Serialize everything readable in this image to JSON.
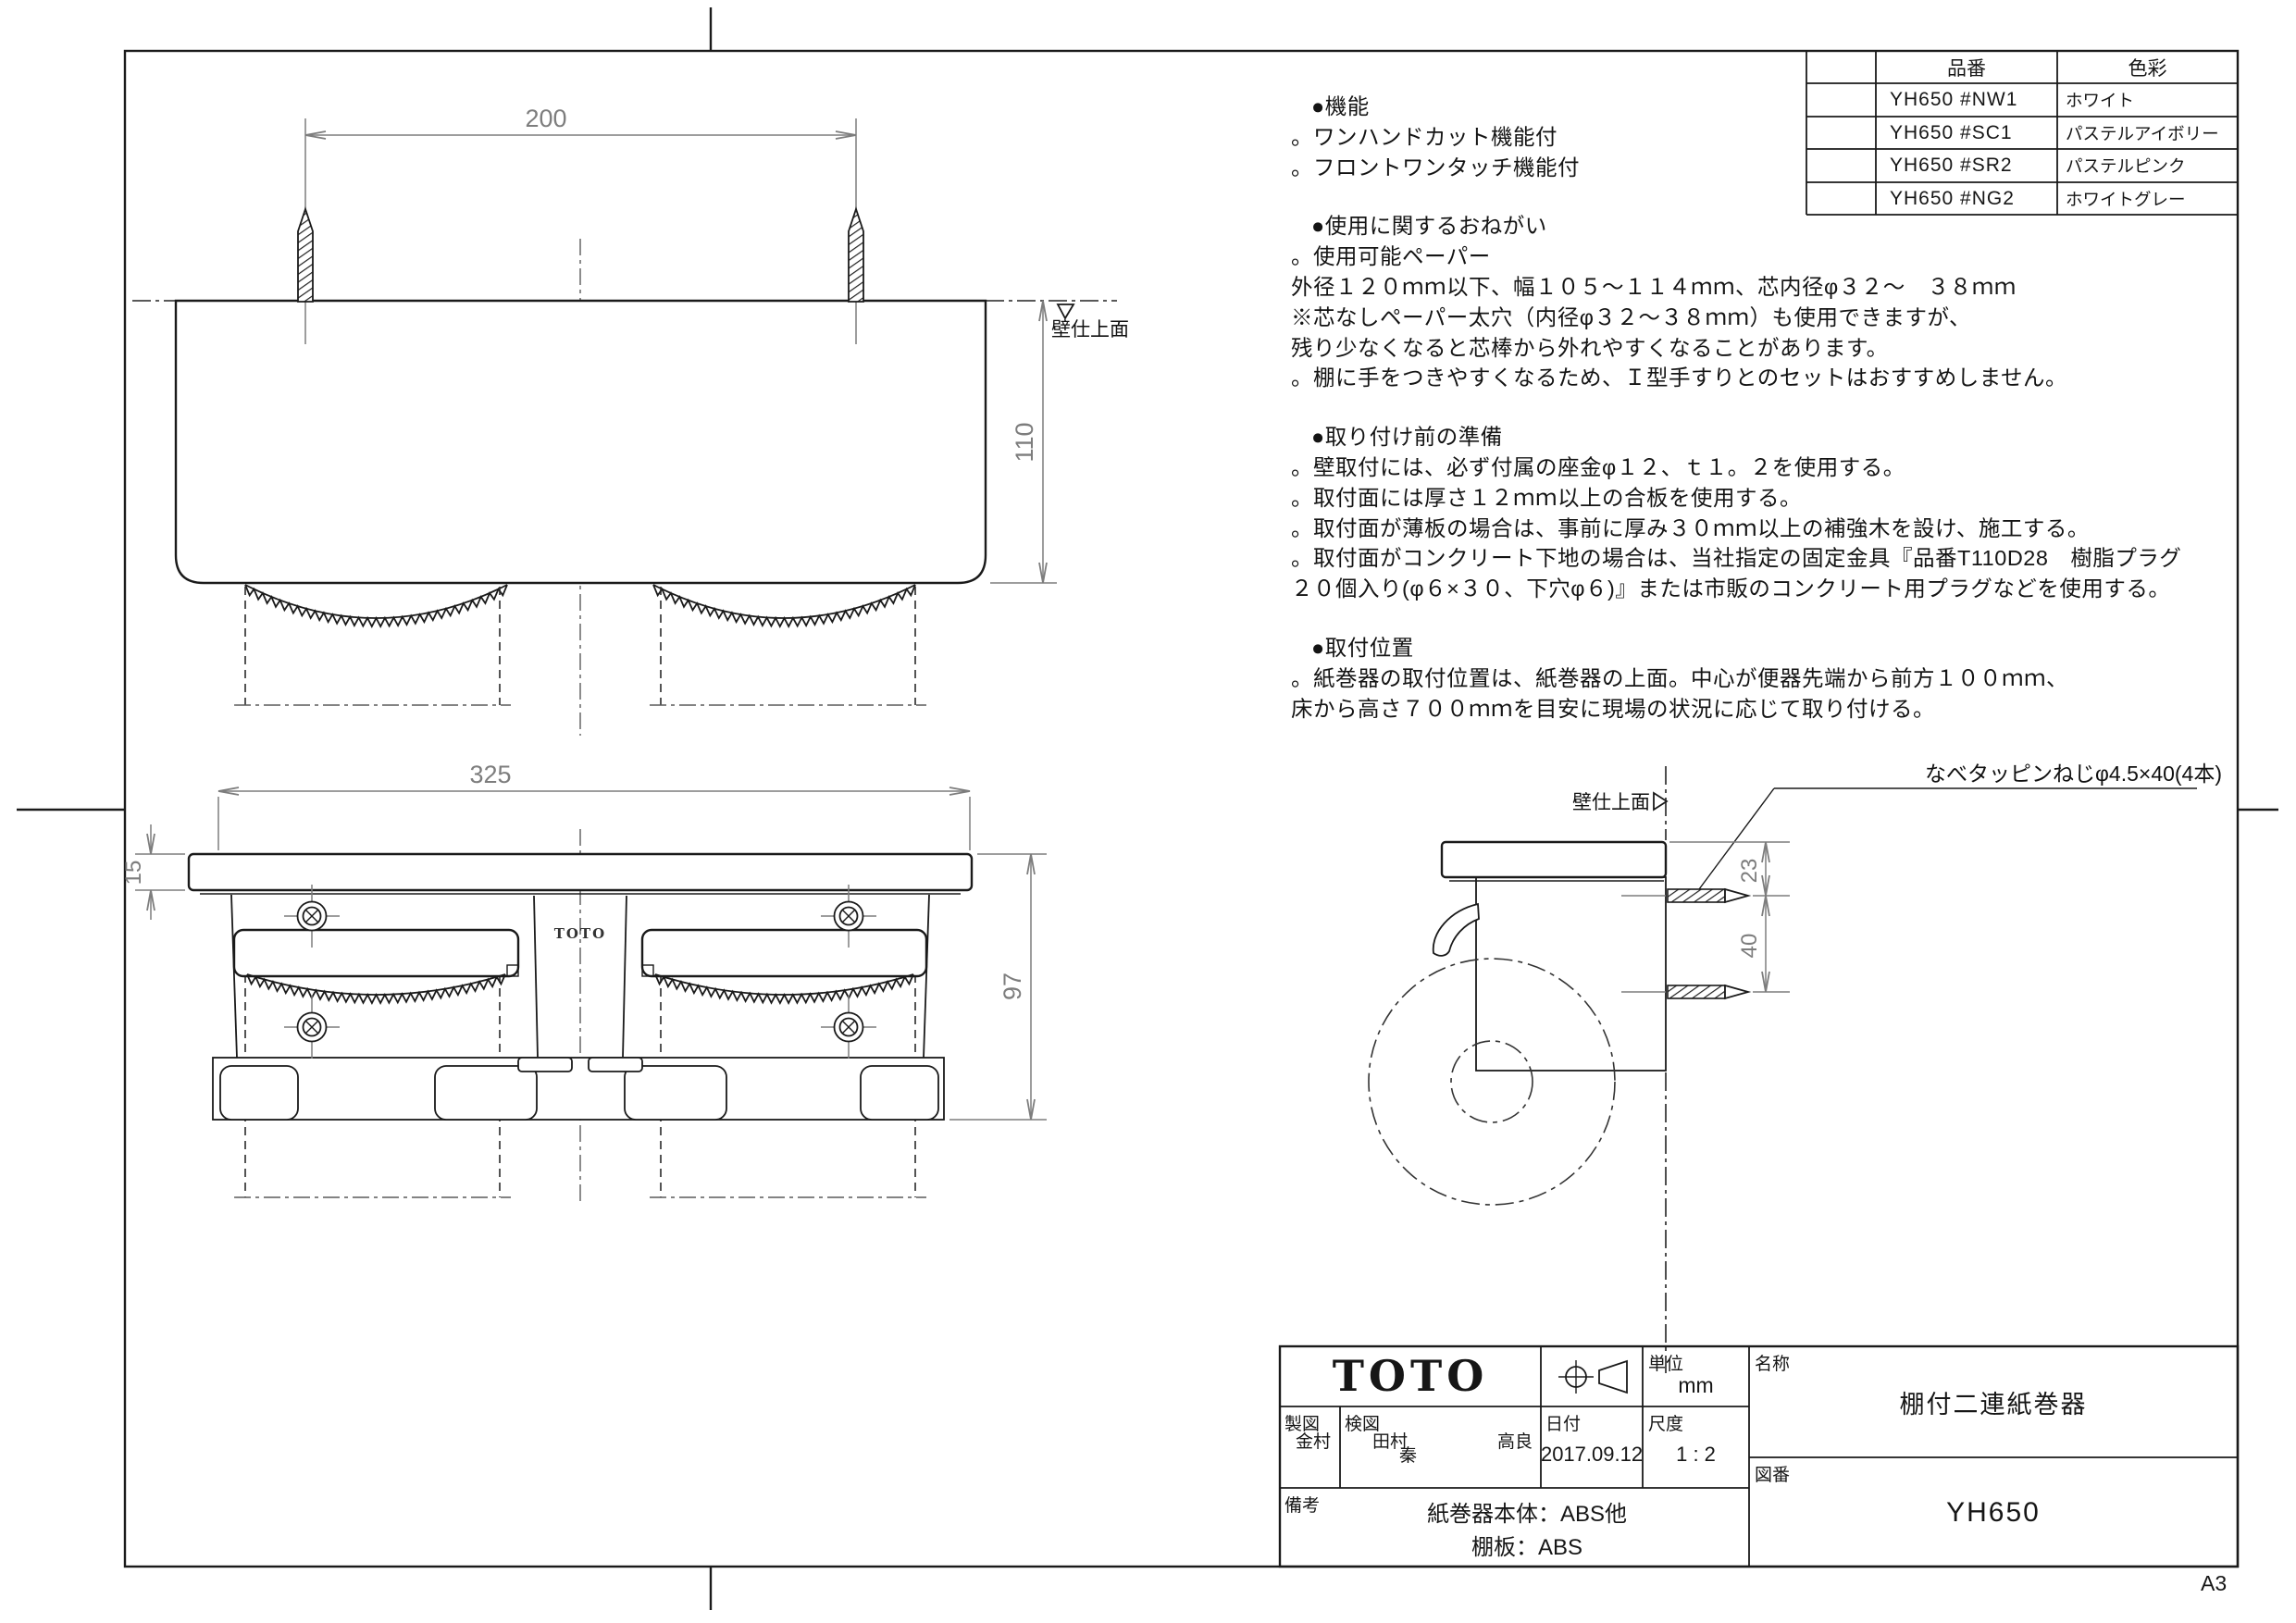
{
  "sheet": {
    "paper_size": "A3"
  },
  "parts_table": {
    "col_code": "品番",
    "col_color": "色彩",
    "rows": [
      {
        "code": "YH650 #NW1",
        "color": "ホワイト"
      },
      {
        "code": "YH650 #SC1",
        "color": "パステルアイボリー"
      },
      {
        "code": "YH650 #SR2",
        "color": "パステルピンク"
      },
      {
        "code": "YH650 #NG2",
        "color": "ホワイトグレー"
      }
    ]
  },
  "notes": {
    "sections": [
      {
        "title": "●機能",
        "lines": [
          "。ワンハンドカット機能付",
          "。フロントワンタッチ機能付"
        ]
      },
      {
        "title": "●使用に関するおねがい",
        "lines": [
          "。使用可能ペーパー",
          "外径１２０ｍｍ以下、幅１０５～１１４ｍｍ、芯内径φ３２～　３８ｍｍ",
          "※芯なしペーパー太穴（内径φ３２～３８ｍｍ）も使用できますが、",
          "残り少なくなると芯棒から外れやすくなることがあります。",
          "。棚に手をつきやすくなるため、Ｉ型手すりとのセットはおすすめしません。"
        ]
      },
      {
        "title": "●取り付け前の準備",
        "lines": [
          "。壁取付には、必ず付属の座金φ１２、ｔ１。２を使用する。",
          "。取付面には厚さ１２ｍｍ以上の合板を使用する。",
          "。取付面が薄板の場合は、事前に厚み３０ｍｍ以上の補強木を設け、施工する。",
          "。取付面がコンクリート下地の場合は、当社指定の固定金具『品番T110D28　樹脂プラグ",
          "２０個入り(φ６×３０、下穴φ６)』または市販のコンクリート用プラグなどを使用する。"
        ]
      },
      {
        "title": "●取付位置",
        "lines": [
          "。紙巻器の取付位置は、紙巻器の上面。中心が便器先端から前方１００ｍｍ、",
          "床から高さ７００ｍｍを目安に現場の状況に応じて取り付ける。"
        ]
      }
    ]
  },
  "views": {
    "top": {
      "dim_width": "200",
      "dim_depth": "110",
      "wall_label": "壁仕上面"
    },
    "front": {
      "dim_width": "325",
      "dim_shelf": "15",
      "dim_height": "97",
      "logo": "TOTO"
    },
    "side": {
      "dim_offset": "23",
      "dim_pitch": "40",
      "wall_label": "壁仕上面",
      "screw_note": "なべタッピンねじφ4.5×40(4本)"
    }
  },
  "title_block": {
    "logo": "TOTO",
    "unit_label": "単位",
    "unit_value": "mm",
    "drafter_label": "製図",
    "drafter": "金村",
    "checker_label": "検図",
    "checkers": [
      "田村",
      "秦",
      "高良"
    ],
    "date_label": "日付",
    "date": "2017.09.12",
    "scale_label": "尺度",
    "scale": "1 : 2",
    "remarks_label": "備考",
    "remarks": [
      "紙巻器本体：ABS他",
      "棚板：ABS"
    ],
    "name_label": "名称",
    "name": "棚付二連紙巻器",
    "number_label": "図番",
    "number": "YH650"
  }
}
